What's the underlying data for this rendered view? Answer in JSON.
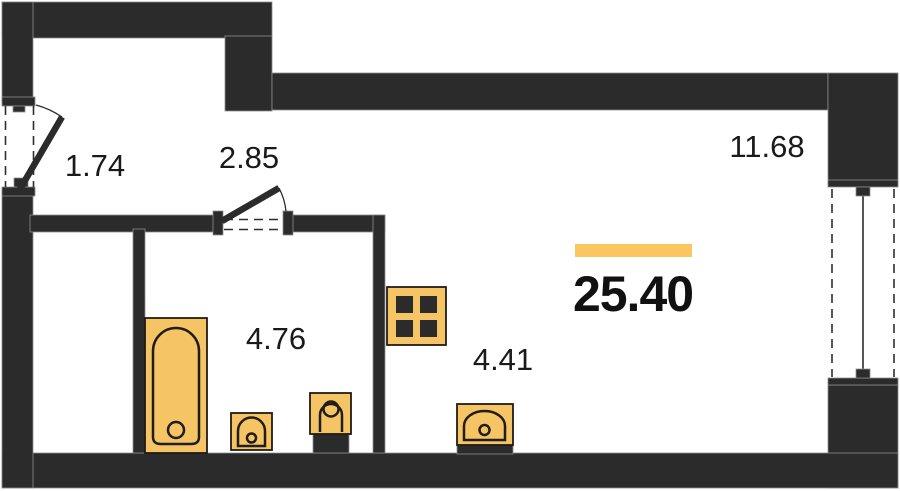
{
  "plan": {
    "type": "studio-apartment-floor-plan",
    "total_area": {
      "value": "25.40",
      "highlight_bar_color": "#fac660"
    },
    "rooms": [
      {
        "id": "entry-hall",
        "area": "1.74"
      },
      {
        "id": "corridor",
        "area": "2.85"
      },
      {
        "id": "bathroom",
        "area": "4.76"
      },
      {
        "id": "kitchen-zone",
        "area": "4.41"
      },
      {
        "id": "living-zone",
        "area": "11.68"
      }
    ],
    "fixtures": [
      {
        "icon": "bathtub-icon",
        "room": "bathroom"
      },
      {
        "icon": "toilet-icon",
        "room": "bathroom"
      },
      {
        "icon": "washbasin-icon",
        "room": "bathroom"
      },
      {
        "icon": "stove-icon",
        "room": "kitchen-zone"
      },
      {
        "icon": "kitchen-sink-icon",
        "room": "kitchen-zone"
      }
    ],
    "openings": [
      {
        "icon": "entry-door-icon",
        "wall": "left"
      },
      {
        "icon": "interior-door-icon",
        "wall": "corridor"
      },
      {
        "icon": "window-icon",
        "wall": "right"
      }
    ],
    "colors": {
      "wall": "#2b2b2b",
      "fixture_fill": "#f5c464",
      "highlight_bar": "#fac660",
      "text": "#1a1a1a",
      "background": "#ffffff"
    }
  }
}
